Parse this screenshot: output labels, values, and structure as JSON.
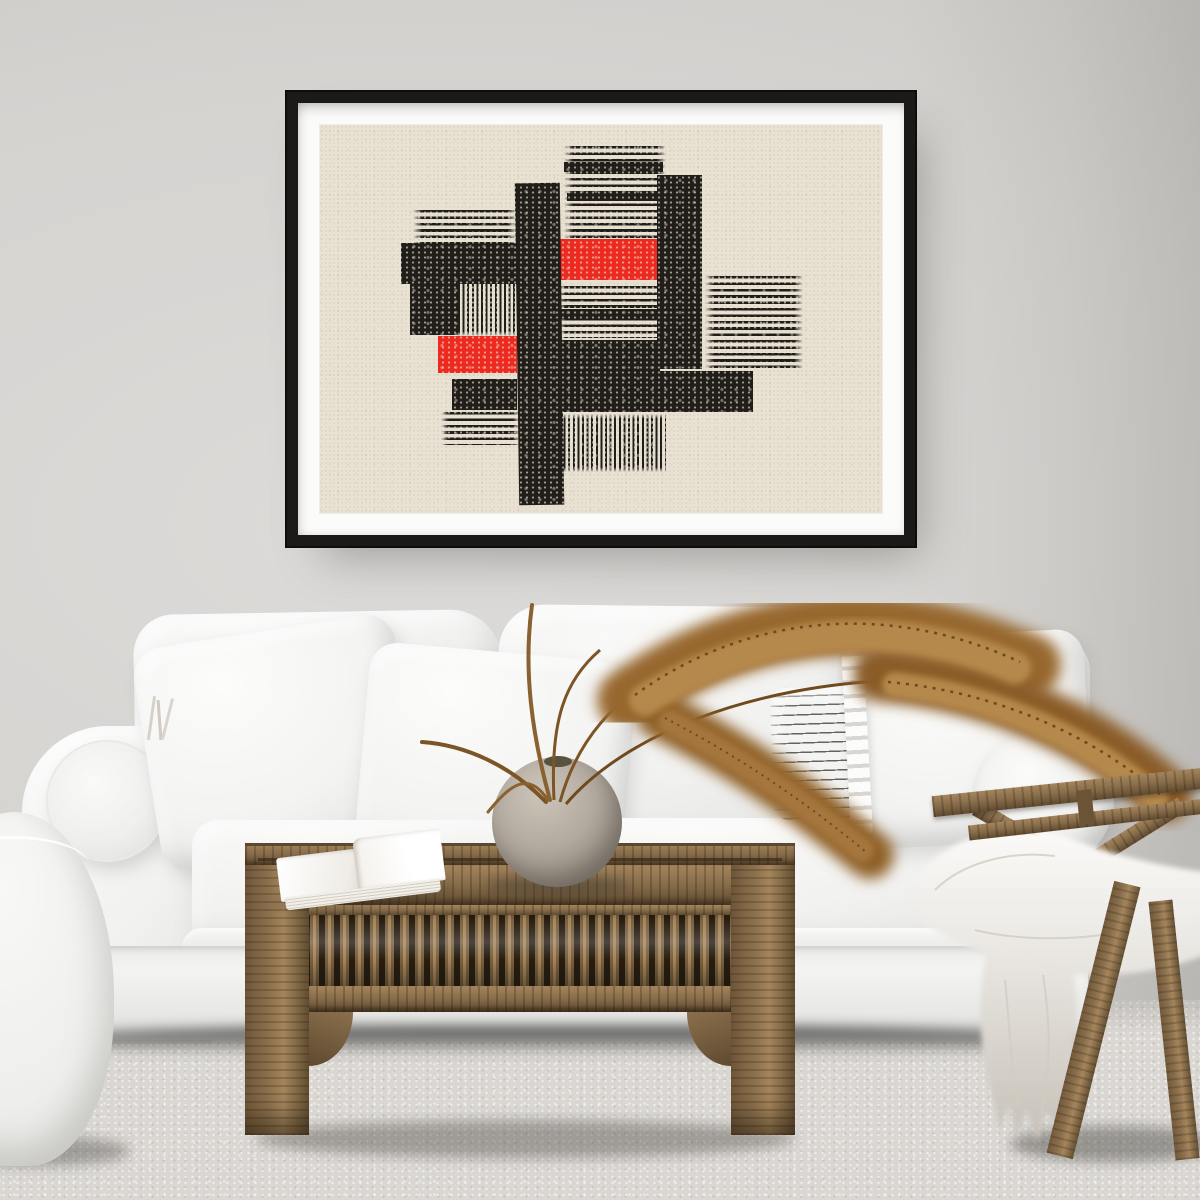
{
  "scene": {
    "objects": [
      "abstract-art-print",
      "picture-frame",
      "white-sofa",
      "throw-pillows",
      "striped-lumbar-pillow",
      "bolster-cushion",
      "white-pouf",
      "carved-wood-coffee-table",
      "open-book",
      "round-stone-vase",
      "dried-pampas-grass",
      "wooden-lounge-chair",
      "white-sheepskin-throw",
      "area-rug"
    ]
  },
  "palette": {
    "wall": "#d5d3d0",
    "wall-dark": "#c2c0bd",
    "rug": "#dad7d3",
    "frame": "#1b1a18",
    "mat": "#fbfbfa",
    "paper": "#e9e2d3",
    "ink": "#211e1a",
    "red": "#ee2a20",
    "wood": "#8a6f4c",
    "wood-dark": "#5f4a30",
    "wood-light": "#a4855c",
    "sofa": "#f2f2f1",
    "pampas": "#97682e",
    "pampas-light": "#b5884c",
    "pampas-dark": "#6f4a1d",
    "vase": "#b0a79c",
    "fur": "#f6f5f2"
  },
  "artwork": {
    "paper_size": {
      "w": 562,
      "h": 388
    },
    "shapes": [
      {
        "n": "stripes-top",
        "t": "h",
        "x": 43.5,
        "y": 5.5,
        "w": 18,
        "h": 24.5
      },
      {
        "n": "band-top-1",
        "t": "rect",
        "x": 43.5,
        "y": 9.5,
        "w": 17.5,
        "h": 2.6,
        "c": "ink"
      },
      {
        "n": "band-top-2",
        "t": "rect",
        "x": 44,
        "y": 17.5,
        "w": 17,
        "h": 2.2,
        "c": "ink"
      },
      {
        "n": "stripes-left",
        "t": "h",
        "x": 16.5,
        "y": 22,
        "w": 18.5,
        "h": 8.5
      },
      {
        "n": "rect-left-big",
        "t": "rect",
        "x": 14.5,
        "y": 30.5,
        "w": 20.5,
        "h": 10.5,
        "c": "ink"
      },
      {
        "n": "rect-left-small",
        "t": "rect",
        "x": 16,
        "y": 41,
        "w": 8.5,
        "h": 13,
        "c": "ink"
      },
      {
        "n": "stripes-left-vertical",
        "t": "v",
        "x": 24.5,
        "y": 40,
        "w": 10.5,
        "h": 14.5
      },
      {
        "n": "red-left",
        "t": "rect",
        "x": 21,
        "y": 54.5,
        "w": 14,
        "h": 9.5,
        "c": "red"
      },
      {
        "n": "rect-left-bottom",
        "t": "rect",
        "x": 23.5,
        "y": 65.5,
        "w": 11.5,
        "h": 8,
        "c": "ink"
      },
      {
        "n": "stripes-left-bottom",
        "t": "h",
        "x": 21.5,
        "y": 74,
        "w": 14,
        "h": 8.5
      },
      {
        "n": "red-center",
        "t": "rect",
        "x": 42.5,
        "y": 29.5,
        "w": 18.5,
        "h": 10.5,
        "c": "red"
      },
      {
        "n": "stripes-center",
        "t": "h",
        "x": 42,
        "y": 41.5,
        "w": 19.5,
        "h": 13.5
      },
      {
        "n": "band-center",
        "t": "rect",
        "x": 42,
        "y": 47.5,
        "w": 19,
        "h": 2.4,
        "c": "ink"
      },
      {
        "n": "rect-center",
        "t": "rect",
        "x": 43,
        "y": 55.5,
        "w": 17.5,
        "h": 8,
        "c": "ink"
      },
      {
        "n": "stripes-right",
        "t": "h",
        "x": 68.5,
        "y": 39,
        "w": 17.5,
        "h": 24
      },
      {
        "n": "bar-right",
        "t": "rect",
        "x": 60,
        "y": 13,
        "w": 8,
        "h": 50,
        "c": "ink"
      },
      {
        "n": "bar-wide",
        "t": "rect",
        "x": 41,
        "y": 63.5,
        "w": 36,
        "h": 10.5,
        "c": "ink"
      },
      {
        "n": "stripes-bottom-vertical",
        "t": "v",
        "x": 42.5,
        "y": 74.5,
        "w": 19,
        "h": 15
      },
      {
        "n": "bar-tall",
        "t": "rect",
        "x": 35,
        "y": 15,
        "w": 8,
        "h": 83,
        "c": "ink",
        "r": -0.8
      }
    ]
  }
}
